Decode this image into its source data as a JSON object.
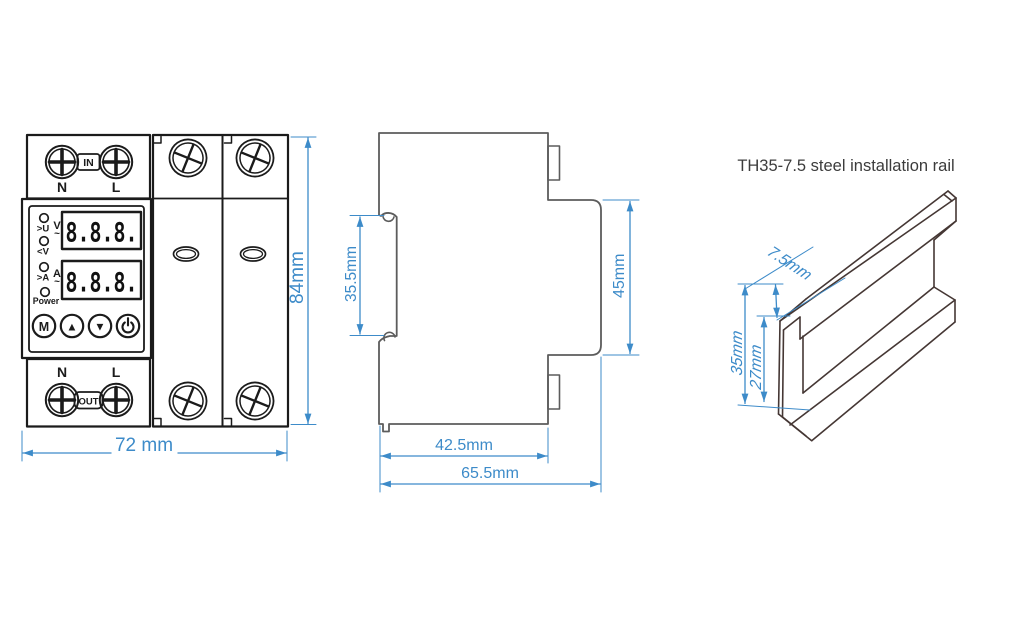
{
  "front_view": {
    "terminal_top": {
      "in_label": "IN",
      "n": "N",
      "l": "L"
    },
    "terminal_bottom": {
      "out_label": "OUT",
      "n": "N",
      "l": "L"
    },
    "panel": {
      "leds": {
        "over_voltage": ">U",
        "under_voltage": "<V",
        "over_current": ">A",
        "power": "Power"
      },
      "units": {
        "volt": "V",
        "volt_wave": "~",
        "amp": "A",
        "amp_wave": "~"
      },
      "display_voltage": "8.8.8.",
      "display_current": "8.8.8.",
      "buttons": {
        "menu": "M",
        "up": "▲",
        "down": "▼"
      }
    },
    "dim_width": "72 mm",
    "dim_height": "84mm"
  },
  "side_view": {
    "dim_rail_slot": "35.5mm",
    "dim_body_height": "45mm",
    "dim_body_depth": "42.5mm",
    "dim_total_depth": "65.5mm"
  },
  "rail": {
    "title": "TH35-7.5 steel installation rail",
    "dim_depth": "7.5mm",
    "dim_height": "35mm",
    "dim_inner_height": "27mm"
  },
  "colors": {
    "dimension_blue": "#3d8bc9",
    "front_outline": "#1b1b1b",
    "side_outline": "#5c5c5c",
    "rail_outline": "#453734",
    "title_text": "#3c3c3c"
  }
}
